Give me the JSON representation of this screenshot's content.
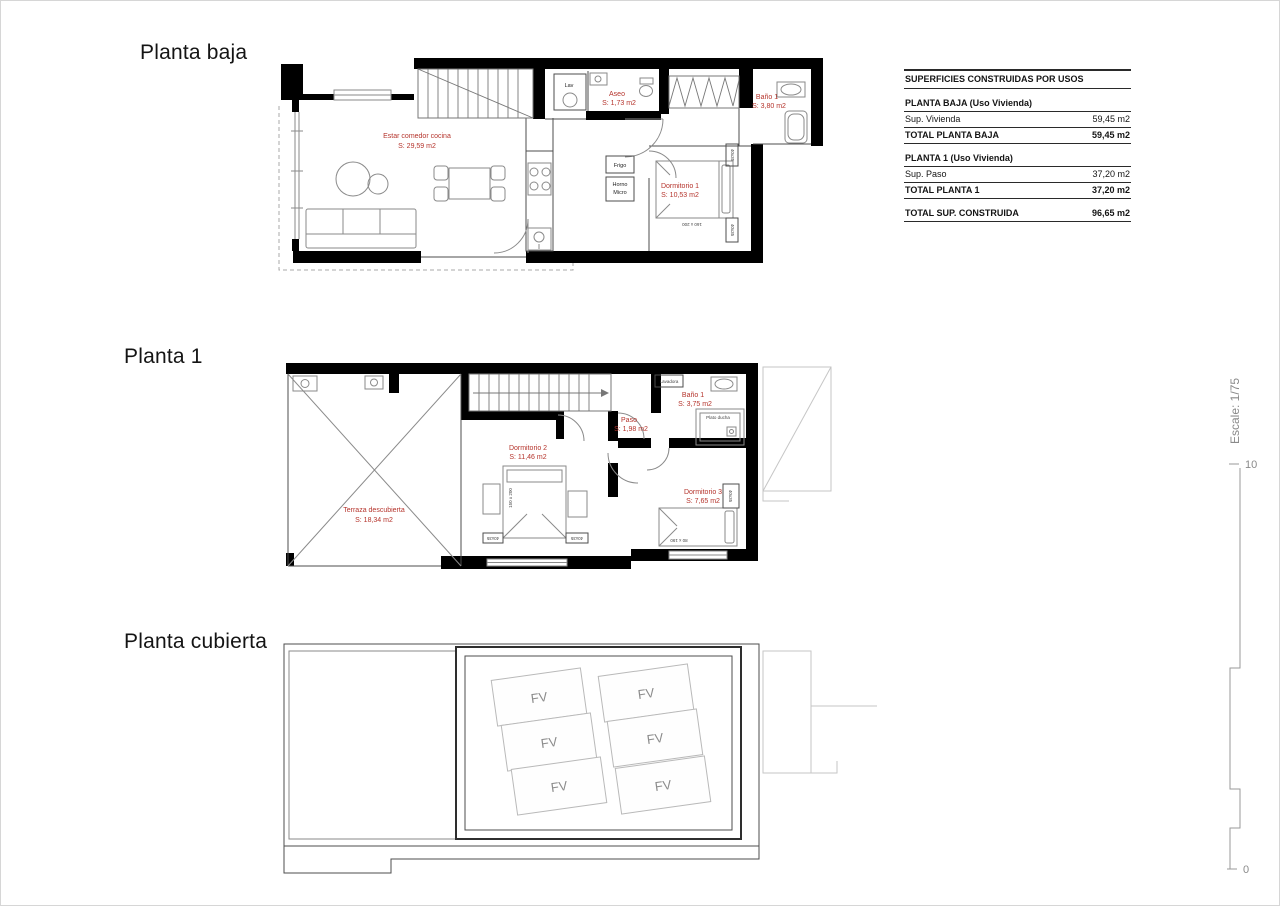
{
  "titles": {
    "planta_baja": "Planta baja",
    "planta_1": "Planta 1",
    "planta_cubierta": "Planta cubierta"
  },
  "summary_table": {
    "title": "SUPERFICIES CONSTRUIDAS POR USOS",
    "sections": [
      {
        "header": "PLANTA BAJA (Uso Vivienda)",
        "rows": [
          {
            "label": "Sup. Vivienda",
            "value": "59,45 m2"
          },
          {
            "label": "TOTAL PLANTA BAJA",
            "value": "59,45 m2"
          }
        ]
      },
      {
        "header": "PLANTA 1 (Uso Vivienda)",
        "rows": [
          {
            "label": "Sup. Paso",
            "value": "37,20 m2"
          },
          {
            "label": "TOTAL PLANTA 1",
            "value": "37,20 m2"
          }
        ]
      }
    ],
    "total": {
      "label": "TOTAL SUP. CONSTRUIDA",
      "value": "96,65 m2"
    }
  },
  "planta_baja": {
    "rooms": [
      {
        "name": "Estar comedor cocina",
        "area": "S: 29,59 m2"
      },
      {
        "name": "Aseo",
        "area": "S: 1,73 m2"
      },
      {
        "name": "Baño 1",
        "area": "S: 3,80 m2"
      },
      {
        "name": "Dormitorio 1",
        "area": "S: 10,53 m2"
      }
    ],
    "fixtures": {
      "lav": "Lav",
      "frigo": "Frigo",
      "horno": "Horno",
      "micro": "Micro",
      "bed_size": "160 x 200",
      "closet": "40x35"
    }
  },
  "planta_1": {
    "rooms": [
      {
        "name": "Terraza descubierta",
        "area": "S: 18,34 m2"
      },
      {
        "name": "Dormitorio 2",
        "area": "S: 11,46 m2"
      },
      {
        "name": "Paso",
        "area": "S: 1,98 m2"
      },
      {
        "name": "Baño 1",
        "area": "S: 3,75 m2"
      },
      {
        "name": "Dormitorio 3",
        "area": "S: 7,65 m2"
      }
    ],
    "fixtures": {
      "lavadora": "Lavadora",
      "plato_ducha": "Plato ducha",
      "bed2_size": "150 x 200",
      "bed3_size": "80 x 190",
      "closet": "40x35"
    }
  },
  "planta_cubierta": {
    "panel_label": "FV",
    "panel_count": 6
  },
  "scale_bar": {
    "label": "Escale: 1/75",
    "top_value": "10",
    "bottom_value": "0"
  },
  "colors": {
    "wall": "#000000",
    "room_label_red": "#b5342c",
    "drawing_gray": "#8a8a8a",
    "roof_light_gray": "#b9b9b9"
  }
}
